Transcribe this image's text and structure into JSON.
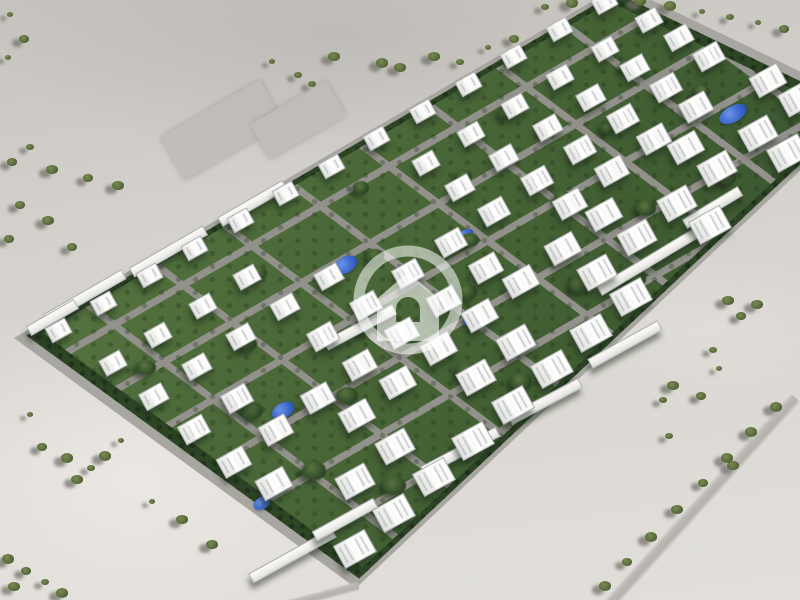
{
  "meta": {
    "kind": "aerial-3d-render",
    "subject": "residential compound master plan in desert"
  },
  "palette": {
    "desert": "#d4d1cc",
    "desert_light": "#e4e1dc",
    "desert_dark": "#bdbab5",
    "road": "#a8a6a1",
    "street": "#93918b",
    "hedge": "#2d4425",
    "lawn": "#4c6a39",
    "building": "#f6f5f1",
    "building_shade": "#cdd2d6",
    "tree": "#31492a",
    "bush": "#5f7040",
    "pond": "#3c67cb",
    "watermark": "#ffffff"
  },
  "site": {
    "corners": [
      [
        14,
        338
      ],
      [
        620,
        -15
      ],
      [
        870,
        105
      ],
      [
        356,
        588
      ]
    ],
    "inset_hedge": 0.972,
    "inset_lawn": 0.938
  },
  "watermark": {
    "icon": "home-circle-watermark",
    "cx": 408,
    "cy": 300,
    "ring_r": 49,
    "ring_w": 11,
    "ring_opacity": 0.55,
    "house_opacity": 0.6,
    "house_path": "M408 272 L439 299 L439 341 L377 341 L377 299 Z M396 322 L396 309 A12 12 0 0 1 420 309 L420 322 Z"
  },
  "grid": {
    "cols": 13,
    "rows": 8,
    "u0": 0.05,
    "u1": 0.96,
    "v0": 0.06,
    "v1": 0.94,
    "bldg_w": 30,
    "bldg_h": 22,
    "rot": -29,
    "scale_base": 0.72,
    "scale_v": 0.5,
    "skip": [
      [
        4,
        1
      ],
      [
        5,
        1
      ],
      [
        6,
        1
      ],
      [
        5,
        2
      ],
      [
        6,
        2
      ],
      [
        11,
        5
      ],
      [
        9,
        5
      ],
      [
        2,
        3
      ],
      [
        7,
        4
      ],
      [
        3,
        6
      ],
      [
        8,
        7
      ],
      [
        1,
        5
      ],
      [
        10,
        7
      ],
      [
        12,
        4
      ],
      [
        6,
        6
      ],
      [
        0,
        6
      ]
    ]
  },
  "terrace_rows": [
    [
      85,
      297,
      90,
      -30
    ],
    [
      168,
      252,
      85,
      -30
    ],
    [
      252,
      204,
      75,
      -30
    ],
    [
      52,
      318,
      55,
      -30
    ],
    [
      360,
      328,
      78,
      -28
    ],
    [
      648,
      262,
      115,
      -31
    ],
    [
      712,
      208,
      65,
      -31
    ],
    [
      292,
      556,
      95,
      -29
    ],
    [
      345,
      520,
      70,
      -29
    ],
    [
      460,
      452,
      85,
      -28
    ],
    [
      545,
      402,
      80,
      -28
    ],
    [
      625,
      345,
      80,
      -29
    ]
  ],
  "ponds": [
    [
      345,
      265,
      26,
      16
    ],
    [
      465,
      235,
      18,
      11
    ],
    [
      472,
      318,
      20,
      13
    ],
    [
      733,
      114,
      30,
      16
    ],
    [
      283,
      410,
      24,
      15
    ],
    [
      262,
      503,
      18,
      12
    ],
    [
      350,
      492,
      16,
      10
    ]
  ],
  "clumps_uv": [
    [
      0.08,
      0.25,
      20
    ],
    [
      0.12,
      0.5,
      22
    ],
    [
      0.1,
      0.72,
      24
    ],
    [
      0.2,
      0.35,
      18
    ],
    [
      0.22,
      0.62,
      22
    ],
    [
      0.3,
      0.2,
      16
    ],
    [
      0.32,
      0.5,
      20
    ],
    [
      0.35,
      0.78,
      24
    ],
    [
      0.42,
      0.35,
      18
    ],
    [
      0.45,
      0.6,
      20
    ],
    [
      0.5,
      0.15,
      16
    ],
    [
      0.52,
      0.48,
      18
    ],
    [
      0.55,
      0.8,
      22
    ],
    [
      0.6,
      0.3,
      16
    ],
    [
      0.65,
      0.55,
      18
    ],
    [
      0.7,
      0.75,
      20
    ],
    [
      0.72,
      0.2,
      14
    ],
    [
      0.78,
      0.45,
      16
    ],
    [
      0.82,
      0.65,
      18
    ],
    [
      0.88,
      0.3,
      14
    ],
    [
      0.9,
      0.55,
      16
    ],
    [
      0.38,
      0.9,
      22
    ],
    [
      0.6,
      0.9,
      20
    ],
    [
      0.8,
      0.85,
      18
    ],
    [
      0.15,
      0.88,
      24
    ],
    [
      0.05,
      0.45,
      20
    ]
  ],
  "bushes": [
    [
      10,
      15
    ],
    [
      24,
      40
    ],
    [
      8,
      58
    ],
    [
      30,
      148
    ],
    [
      12,
      163
    ],
    [
      52,
      171
    ],
    [
      88,
      179
    ],
    [
      118,
      187
    ],
    [
      20,
      206
    ],
    [
      48,
      222
    ],
    [
      9,
      240
    ],
    [
      72,
      248
    ],
    [
      272,
      62
    ],
    [
      298,
      76
    ],
    [
      312,
      85
    ],
    [
      334,
      58
    ],
    [
      382,
      64
    ],
    [
      400,
      69
    ],
    [
      434,
      58
    ],
    [
      460,
      63
    ],
    [
      488,
      48
    ],
    [
      514,
      40
    ],
    [
      545,
      8
    ],
    [
      572,
      4
    ],
    [
      640,
      2
    ],
    [
      670,
      7
    ],
    [
      702,
      12
    ],
    [
      730,
      18
    ],
    [
      758,
      23
    ],
    [
      784,
      30
    ],
    [
      728,
      302
    ],
    [
      757,
      306
    ],
    [
      741,
      317
    ],
    [
      713,
      351
    ],
    [
      719,
      369
    ],
    [
      673,
      387
    ],
    [
      701,
      397
    ],
    [
      663,
      401
    ],
    [
      669,
      437
    ],
    [
      733,
      467
    ],
    [
      776,
      408
    ],
    [
      751,
      433
    ],
    [
      727,
      459
    ],
    [
      703,
      484
    ],
    [
      677,
      511
    ],
    [
      651,
      538
    ],
    [
      627,
      563
    ],
    [
      605,
      587
    ],
    [
      42,
      448
    ],
    [
      67,
      459
    ],
    [
      91,
      469
    ],
    [
      77,
      481
    ],
    [
      105,
      457
    ],
    [
      30,
      415
    ],
    [
      121,
      441
    ],
    [
      8,
      560
    ],
    [
      26,
      572
    ],
    [
      14,
      588
    ],
    [
      45,
      583
    ],
    [
      62,
      594
    ],
    [
      182,
      521
    ],
    [
      212,
      546
    ],
    [
      152,
      502
    ]
  ],
  "pads": [
    [
      222,
      130,
      115,
      50,
      -30
    ],
    [
      298,
      120,
      88,
      40,
      -30
    ]
  ],
  "desert_roads": [
    [
      701,
      502,
      282,
      13,
      -48
    ],
    [
      320,
      596,
      80,
      10,
      -15
    ]
  ]
}
